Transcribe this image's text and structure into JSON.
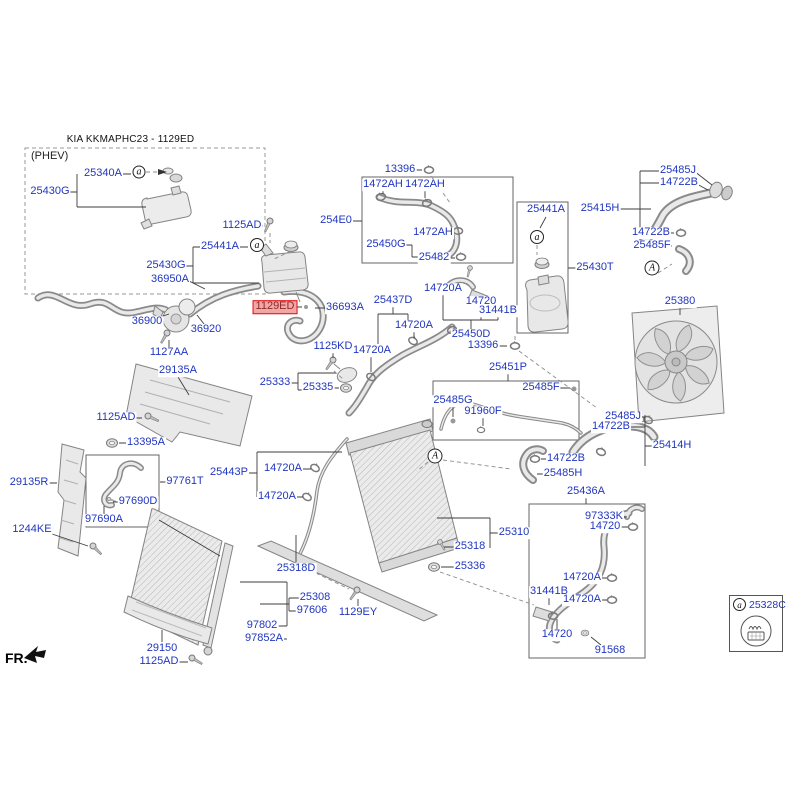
{
  "diagram": {
    "title": "KIA KKMAPHC23 - 1129ED",
    "phev_label": "(PHEV)",
    "fr_label": "FR.",
    "label_color": "#2136c0",
    "highlight": {
      "text_color": "#8e2a2a",
      "bg": "#f2a6a6",
      "border": "#e01010"
    },
    "legend": {
      "marker": "a",
      "part_number": "25328C",
      "pictogram": "pressure-cap-warning-icon"
    },
    "markers": [
      {
        "letter": "a",
        "x": 139,
        "y": 172,
        "size": 13
      },
      {
        "letter": "a",
        "x": 257,
        "y": 245,
        "size": 14
      },
      {
        "letter": "a",
        "x": 537,
        "y": 237,
        "size": 14
      },
      {
        "letter": "A",
        "x": 652,
        "y": 268,
        "size": 15
      },
      {
        "letter": "A",
        "x": 435,
        "y": 456,
        "size": 15
      }
    ],
    "labels": [
      {
        "text": "25340A",
        "x": 103,
        "y": 174
      },
      {
        "text": "25430G",
        "x": 50,
        "y": 192
      },
      {
        "text": "1125AD",
        "x": 242,
        "y": 226
      },
      {
        "text": "25441A",
        "x": 220,
        "y": 247
      },
      {
        "text": "25430G",
        "x": 166,
        "y": 266
      },
      {
        "text": "36950A",
        "x": 170,
        "y": 280
      },
      {
        "text": "36900",
        "x": 147,
        "y": 322
      },
      {
        "text": "36920",
        "x": 206,
        "y": 330
      },
      {
        "text": "1129ED",
        "x": 275,
        "y": 307,
        "hl": true
      },
      {
        "text": "36693A",
        "x": 345,
        "y": 308
      },
      {
        "text": "1127AA",
        "x": 169,
        "y": 353
      },
      {
        "text": "29135A",
        "x": 178,
        "y": 371
      },
      {
        "text": "1125AD",
        "x": 116,
        "y": 418
      },
      {
        "text": "13395A",
        "x": 146,
        "y": 443
      },
      {
        "text": "25333",
        "x": 275,
        "y": 383
      },
      {
        "text": "25335",
        "x": 318,
        "y": 388
      },
      {
        "text": "1125KD",
        "x": 333,
        "y": 347
      },
      {
        "text": "14720A",
        "x": 372,
        "y": 351
      },
      {
        "text": "13396",
        "x": 400,
        "y": 170
      },
      {
        "text": "1472AH",
        "x": 383,
        "y": 185
      },
      {
        "text": "1472AH",
        "x": 425,
        "y": 185
      },
      {
        "text": "254E0",
        "x": 336,
        "y": 221
      },
      {
        "text": "1472AH",
        "x": 433,
        "y": 233
      },
      {
        "text": "25450G",
        "x": 386,
        "y": 245
      },
      {
        "text": "25482",
        "x": 434,
        "y": 258
      },
      {
        "text": "25441A",
        "x": 546,
        "y": 210
      },
      {
        "text": "25430T",
        "x": 595,
        "y": 268
      },
      {
        "text": "25415H",
        "x": 600,
        "y": 209
      },
      {
        "text": "25485J",
        "x": 678,
        "y": 171
      },
      {
        "text": "14722B",
        "x": 679,
        "y": 183
      },
      {
        "text": "14722B",
        "x": 651,
        "y": 233
      },
      {
        "text": "25485F",
        "x": 652,
        "y": 246
      },
      {
        "text": "25380",
        "x": 680,
        "y": 302
      },
      {
        "text": "25437D",
        "x": 393,
        "y": 301
      },
      {
        "text": "14720A",
        "x": 414,
        "y": 326
      },
      {
        "text": "14720A",
        "x": 443,
        "y": 289
      },
      {
        "text": "14720",
        "x": 481,
        "y": 302
      },
      {
        "text": "31441B",
        "x": 498,
        "y": 311
      },
      {
        "text": "25450D",
        "x": 471,
        "y": 335
      },
      {
        "text": "13396",
        "x": 483,
        "y": 346
      },
      {
        "text": "25451P",
        "x": 508,
        "y": 368
      },
      {
        "text": "25485F",
        "x": 541,
        "y": 388
      },
      {
        "text": "25485G",
        "x": 453,
        "y": 401
      },
      {
        "text": "91960F",
        "x": 483,
        "y": 412
      },
      {
        "text": "25485J",
        "x": 623,
        "y": 417
      },
      {
        "text": "14722B",
        "x": 611,
        "y": 427
      },
      {
        "text": "25414H",
        "x": 672,
        "y": 446
      },
      {
        "text": "14722B",
        "x": 566,
        "y": 459
      },
      {
        "text": "25485H",
        "x": 563,
        "y": 474
      },
      {
        "text": "29135R",
        "x": 29,
        "y": 483
      },
      {
        "text": "97761T",
        "x": 185,
        "y": 482
      },
      {
        "text": "97690D",
        "x": 138,
        "y": 502
      },
      {
        "text": "97690A",
        "x": 104,
        "y": 520
      },
      {
        "text": "1244KE",
        "x": 32,
        "y": 530
      },
      {
        "text": "25443P",
        "x": 229,
        "y": 473
      },
      {
        "text": "14720A",
        "x": 283,
        "y": 469
      },
      {
        "text": "14720A",
        "x": 277,
        "y": 497
      },
      {
        "text": "25310",
        "x": 514,
        "y": 533
      },
      {
        "text": "25318",
        "x": 470,
        "y": 547
      },
      {
        "text": "25336",
        "x": 470,
        "y": 567
      },
      {
        "text": "25318D",
        "x": 296,
        "y": 569
      },
      {
        "text": "25308",
        "x": 315,
        "y": 598
      },
      {
        "text": "97606",
        "x": 312,
        "y": 611
      },
      {
        "text": "1129EY",
        "x": 358,
        "y": 613
      },
      {
        "text": "97802",
        "x": 262,
        "y": 626
      },
      {
        "text": "97852A",
        "x": 264,
        "y": 639
      },
      {
        "text": "29150",
        "x": 162,
        "y": 649
      },
      {
        "text": "1125AD",
        "x": 159,
        "y": 662
      },
      {
        "text": "25436A",
        "x": 586,
        "y": 492
      },
      {
        "text": "97333K",
        "x": 604,
        "y": 517
      },
      {
        "text": "14720",
        "x": 605,
        "y": 527
      },
      {
        "text": "14720A",
        "x": 582,
        "y": 578
      },
      {
        "text": "31441B",
        "x": 549,
        "y": 592
      },
      {
        "text": "14720A",
        "x": 582,
        "y": 600
      },
      {
        "text": "14720",
        "x": 557,
        "y": 635
      },
      {
        "text": "91568",
        "x": 610,
        "y": 651
      }
    ]
  }
}
